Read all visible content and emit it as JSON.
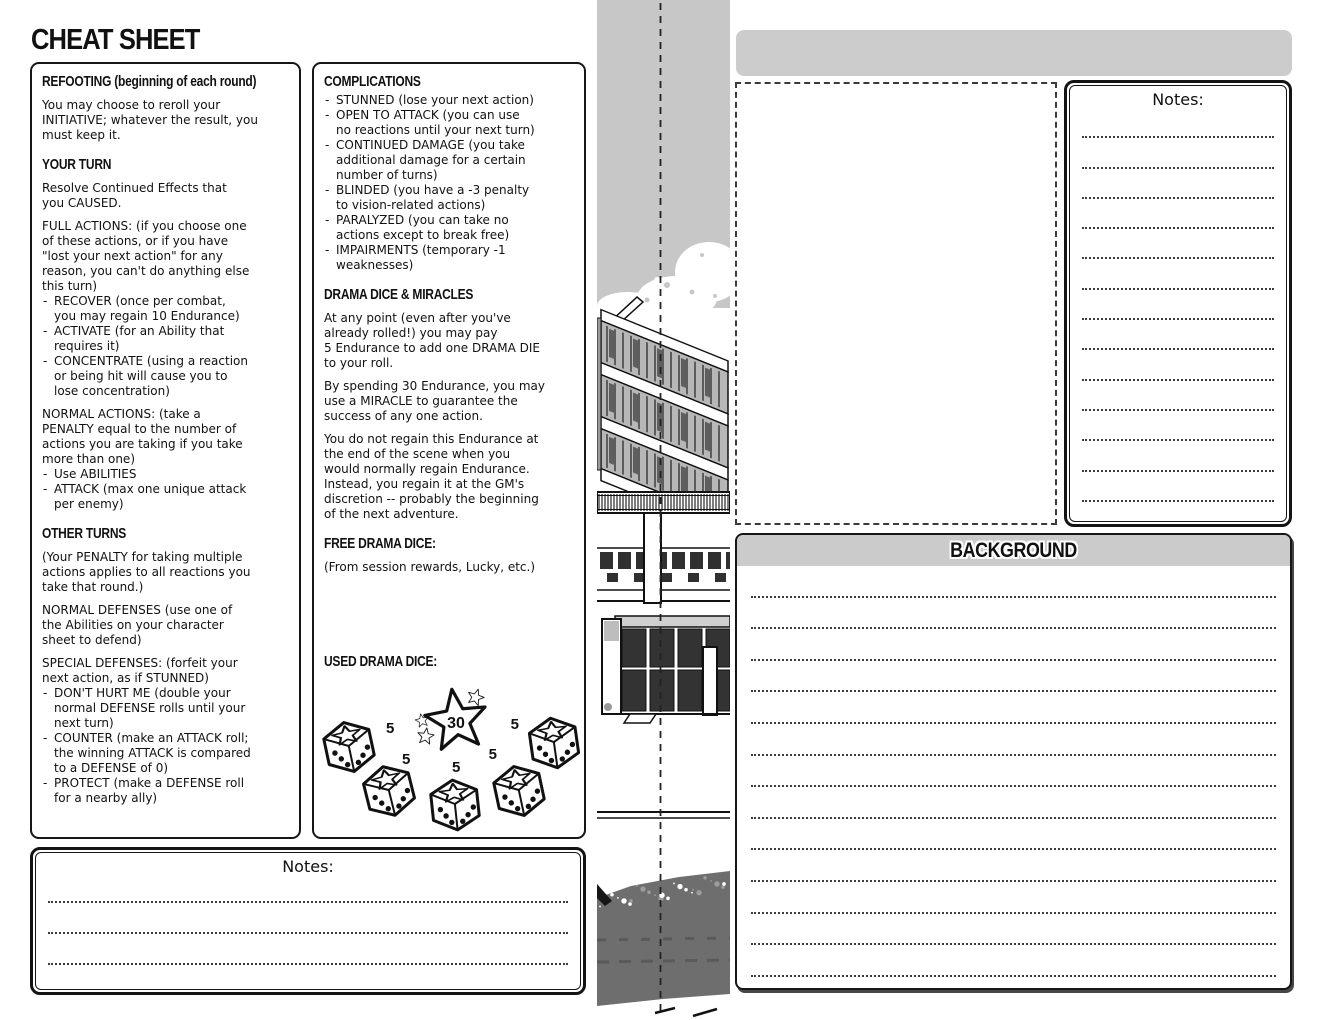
{
  "page_title": "CHEAT SHEET",
  "left_box": {
    "sections": [
      {
        "heading": "REFOOTING (beginning of each round)",
        "blocks": [
          {
            "type": "p",
            "text": "You may choose to reroll your\nINITIATIVE; whatever the result, you\nmust keep it."
          }
        ]
      },
      {
        "heading": "YOUR TURN",
        "blocks": [
          {
            "type": "p",
            "text": "Resolve Continued Effects that\nyou CAUSED."
          },
          {
            "type": "p",
            "text": "FULL ACTIONS: (if you choose one\nof these actions, or if you have\n\"lost your next action\" for any\nreason, you can't do anything else\nthis turn)"
          },
          {
            "type": "ul",
            "items": [
              "RECOVER (once per combat,\nyou may regain 10 Endurance)",
              "ACTIVATE (for an Ability that\nrequires it)",
              "CONCENTRATE (using a reaction\nor being hit will cause you to\nlose concentration)"
            ]
          },
          {
            "type": "p",
            "text": "NORMAL ACTIONS: (take a\nPENALTY equal to the number of\nactions you are taking if you take\nmore than one)"
          },
          {
            "type": "ul",
            "items": [
              "Use ABILITIES",
              "ATTACK (max one unique attack\nper enemy)"
            ]
          }
        ]
      },
      {
        "heading": "OTHER TURNS",
        "blocks": [
          {
            "type": "p",
            "text": "(Your PENALTY for taking multiple\nactions applies to all reactions you\ntake that round.)"
          },
          {
            "type": "p",
            "text": "NORMAL DEFENSES (use one of\nthe Abilities on your character\nsheet to defend)"
          },
          {
            "type": "p",
            "text": "SPECIAL DEFENSES: (forfeit your\nnext action, as if STUNNED)"
          },
          {
            "type": "ul",
            "items": [
              "DON'T HURT ME (double your\nnormal DEFENSE rolls until your\nnext turn)",
              "COUNTER (make an ATTACK roll;\nthe winning ATTACK is compared\nto a DEFENSE of 0)",
              "PROTECT (make a DEFENSE roll\nfor a nearby ally)"
            ]
          }
        ]
      }
    ]
  },
  "mid_box": {
    "sections": [
      {
        "heading": "COMPLICATIONS",
        "blocks": [
          {
            "type": "ul",
            "items": [
              "STUNNED (lose your next action)",
              "OPEN TO ATTACK (you can use\nno reactions until your next turn)",
              "CONTINUED DAMAGE (you take\nadditional damage for a certain\nnumber of turns)",
              "BLINDED (you have a -3 penalty\nto vision-related actions)",
              "PARALYZED (you can take no\nactions except to break free)",
              "IMPAIRMENTS (temporary -1\nweaknesses)"
            ]
          }
        ]
      },
      {
        "heading": "DRAMA DICE & MIRACLES",
        "blocks": [
          {
            "type": "p",
            "text": "At any point (even after you've\nalready rolled!) you may pay\n5 Endurance to add one DRAMA DIE\nto your roll."
          },
          {
            "type": "p",
            "text": "By spending 30 Endurance, you may\nuse a MIRACLE to guarantee the\nsuccess of any one action."
          },
          {
            "type": "p",
            "text": "You do not regain this Endurance at\nthe end of the scene when you\nwould normally regain Endurance.\nInstead, you regain it at the GM's\ndiscretion -- probably the beginning\nof the next adventure."
          }
        ]
      },
      {
        "heading": "FREE DRAMA DICE:",
        "blocks": [
          {
            "type": "p",
            "text": "(From session rewards, Lucky, etc.)"
          }
        ]
      },
      {
        "heading": "USED DRAMA DICE:",
        "blocks": []
      }
    ]
  },
  "used_drama_dice": {
    "star": {
      "value": "30"
    },
    "dice": [
      {
        "value": "5"
      },
      {
        "value": "5"
      },
      {
        "value": "5"
      },
      {
        "value": "5"
      },
      {
        "value": "5"
      }
    ]
  },
  "notes_bottom": {
    "label": "Notes:",
    "line_count": 4
  },
  "notes_right": {
    "label": "Notes:",
    "line_count": 14
  },
  "background_box": {
    "title": "BACKGROUND",
    "line_count": 14
  }
}
